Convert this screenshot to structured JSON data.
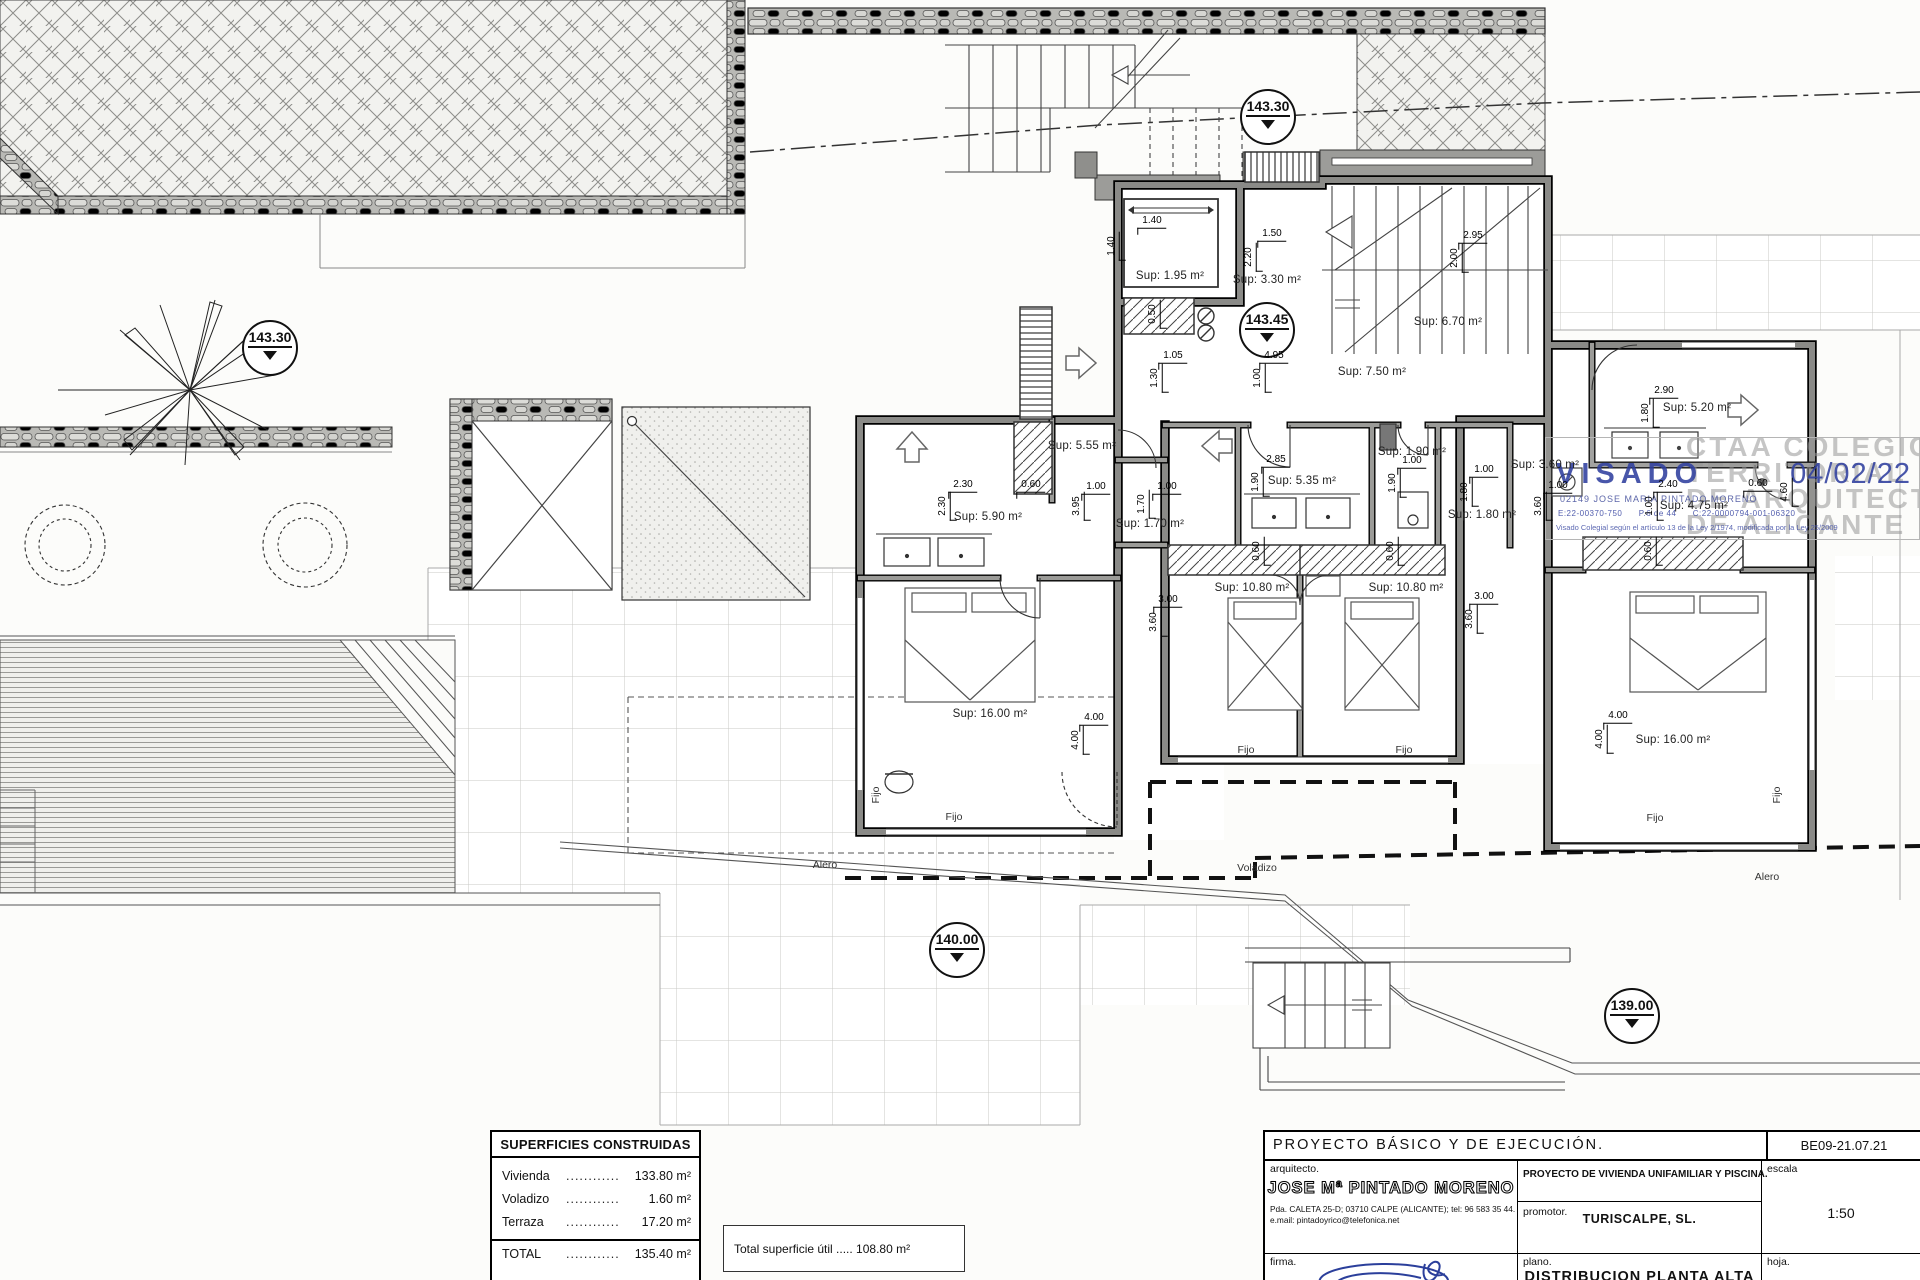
{
  "drawing": {
    "levels": [
      {
        "value": "143.30",
        "x": 1268,
        "y": 117
      },
      {
        "value": "143.45",
        "x": 1267,
        "y": 330
      },
      {
        "value": "143.30",
        "x": 270,
        "y": 348
      },
      {
        "value": "140.00",
        "x": 957,
        "y": 950
      },
      {
        "value": "139.00",
        "x": 1632,
        "y": 1016
      }
    ],
    "rooms": [
      {
        "label": "Sup: 1.95 m²",
        "x": 1170,
        "y": 276
      },
      {
        "label": "Sup: 3.30 m²",
        "x": 1267,
        "y": 280
      },
      {
        "label": "Sup: 6.70 m²",
        "x": 1448,
        "y": 322
      },
      {
        "label": "Sup: 7.50 m²",
        "x": 1372,
        "y": 372
      },
      {
        "label": "Sup: 5.55 m²",
        "x": 1082,
        "y": 446
      },
      {
        "label": "Sup: 5.90 m²",
        "x": 988,
        "y": 517
      },
      {
        "label": "Sup: 1.70 m²",
        "x": 1150,
        "y": 524
      },
      {
        "label": "Sup: 5.35 m²",
        "x": 1302,
        "y": 481
      },
      {
        "label": "Sup: 1.90 m²",
        "x": 1412,
        "y": 452
      },
      {
        "label": "Sup: 1.80 m²",
        "x": 1482,
        "y": 515
      },
      {
        "label": "Sup: 3.60 m²",
        "x": 1545,
        "y": 465
      },
      {
        "label": "Sup: 5.20 m²",
        "x": 1697,
        "y": 408
      },
      {
        "label": "Sup: 4.75 m²",
        "x": 1694,
        "y": 506
      },
      {
        "label": "Sup: 10.80 m²",
        "x": 1252,
        "y": 588
      },
      {
        "label": "Sup: 10.80 m²",
        "x": 1406,
        "y": 588
      },
      {
        "label": "Sup: 16.00 m²",
        "x": 990,
        "y": 714
      },
      {
        "label": "Sup: 16.00 m²",
        "x": 1673,
        "y": 740
      }
    ],
    "dims": [
      {
        "text": "1.40",
        "x": 1152,
        "y": 222
      },
      {
        "text": "1.40",
        "x": 1113,
        "y": 246,
        "v": true
      },
      {
        "text": "1.50",
        "x": 1272,
        "y": 235
      },
      {
        "text": "2.20",
        "x": 1250,
        "y": 257,
        "v": true
      },
      {
        "text": "2.95",
        "x": 1473,
        "y": 237
      },
      {
        "text": "2.00",
        "x": 1456,
        "y": 258,
        "v": true
      },
      {
        "text": "1.05",
        "x": 1173,
        "y": 357
      },
      {
        "text": "1.30",
        "x": 1156,
        "y": 378,
        "v": true
      },
      {
        "text": "4.95",
        "x": 1274,
        "y": 357
      },
      {
        "text": "1.00",
        "x": 1259,
        "y": 378,
        "v": true
      },
      {
        "text": "2.30",
        "x": 963,
        "y": 486
      },
      {
        "text": "2.30",
        "x": 944,
        "y": 506,
        "v": true
      },
      {
        "text": "0.60",
        "x": 1031,
        "y": 486
      },
      {
        "text": "3.95",
        "x": 1078,
        "y": 506,
        "v": true
      },
      {
        "text": "1.00",
        "x": 1096,
        "y": 488
      },
      {
        "text": "1.70",
        "x": 1143,
        "y": 504,
        "v": true
      },
      {
        "text": "1.00",
        "x": 1167,
        "y": 488
      },
      {
        "text": "2.85",
        "x": 1276,
        "y": 461
      },
      {
        "text": "1.90",
        "x": 1257,
        "y": 482,
        "v": true
      },
      {
        "text": "1.00",
        "x": 1412,
        "y": 462
      },
      {
        "text": "1.90",
        "x": 1394,
        "y": 483,
        "v": true
      },
      {
        "text": "1.00",
        "x": 1484,
        "y": 471
      },
      {
        "text": "1.80",
        "x": 1466,
        "y": 492,
        "v": true
      },
      {
        "text": "1.00",
        "x": 1558,
        "y": 487
      },
      {
        "text": "3.60",
        "x": 1540,
        "y": 506,
        "v": true
      },
      {
        "text": "2.90",
        "x": 1664,
        "y": 392
      },
      {
        "text": "1.80",
        "x": 1647,
        "y": 413,
        "v": true
      },
      {
        "text": "2.40",
        "x": 1668,
        "y": 486
      },
      {
        "text": "1.00",
        "x": 1651,
        "y": 506,
        "v": true
      },
      {
        "text": "0.60",
        "x": 1758,
        "y": 485
      },
      {
        "text": "3.00",
        "x": 1168,
        "y": 601
      },
      {
        "text": "3.60",
        "x": 1155,
        "y": 622,
        "v": true
      },
      {
        "text": "3.00",
        "x": 1484,
        "y": 598
      },
      {
        "text": "3.60",
        "x": 1471,
        "y": 619,
        "v": true
      },
      {
        "text": "4.00",
        "x": 1094,
        "y": 719
      },
      {
        "text": "4.00",
        "x": 1077,
        "y": 740,
        "v": true
      },
      {
        "text": "4.00",
        "x": 1618,
        "y": 717
      },
      {
        "text": "4.00",
        "x": 1601,
        "y": 739,
        "v": true
      },
      {
        "text": "4.60",
        "x": 1786,
        "y": 492,
        "v": true
      },
      {
        "text": "0.50",
        "x": 1154,
        "y": 314,
        "v": true
      },
      {
        "text": "0.60",
        "x": 1258,
        "y": 551,
        "v": true
      },
      {
        "text": "0.60",
        "x": 1392,
        "y": 551,
        "v": true
      },
      {
        "text": "0.60",
        "x": 1650,
        "y": 551,
        "v": true
      }
    ],
    "annotations": [
      {
        "text": "Fijo",
        "x": 876,
        "y": 795,
        "v": true
      },
      {
        "text": "Fijo",
        "x": 954,
        "y": 817
      },
      {
        "text": "Fijo",
        "x": 1246,
        "y": 750
      },
      {
        "text": "Fijo",
        "x": 1404,
        "y": 750
      },
      {
        "text": "Fijo",
        "x": 1655,
        "y": 818
      },
      {
        "text": "Fijo",
        "x": 1777,
        "y": 795,
        "v": true
      },
      {
        "text": "Alero",
        "x": 825,
        "y": 865
      },
      {
        "text": "Voladizo",
        "x": 1257,
        "y": 868
      },
      {
        "text": "Alero",
        "x": 1767,
        "y": 877
      }
    ]
  },
  "stamp": {
    "watermark": [
      "CTAA COLEGIO",
      "TERRITORIAL",
      "DE ARQUITECTOS",
      "DE ALICANTE"
    ],
    "visado": "VISADO",
    "date": "04/02/22",
    "colegiado": "02149 JOSE MARIA PINTADO MORENO",
    "refs": "E:22-00370-750      P.6 de 44      C:22-0000794-001-06320",
    "legal": "Visado Colegial según el artículo 13 de la Ley 2/1974, modificada por la Ley 25/2009"
  },
  "areas": {
    "title": "SUPERFICIES CONSTRUIDAS",
    "rows": [
      {
        "name": "Vivienda",
        "dots": "............",
        "value": "133.80 m²"
      },
      {
        "name": "Voladizo",
        "dots": "............",
        "value": "1.60 m²"
      },
      {
        "name": "Terraza",
        "dots": "............",
        "value": "17.20 m²"
      }
    ],
    "total": {
      "name": "TOTAL",
      "dots": "............",
      "value": "135.40 m²"
    }
  },
  "total_note": "Total superficie útil ..... 108.80 m²",
  "titleblock": {
    "header": "PROYECTO  BÁSICO  Y  DE  EJECUCIÓN.",
    "code": "BE09-21.07.21",
    "arquitecto_label": "arquitecto.",
    "arquitecto_name": "JOSE Mª PINTADO MORENO",
    "address": "Pda. CALETA 25-D; 03710 CALPE (ALICANTE); tel: 96 583 35 44.",
    "email": "e.mail: pintadoyrico@telefonica.net",
    "project": "PROYECTO DE VIVIENDA UNIFAMILIAR Y PISCINA.",
    "promotor_label": "promotor.",
    "promotor_name": "TURISCALPE, SL.",
    "escala_label": "escala",
    "escala_value": "1:50",
    "firma_label": "firma.",
    "plano_label": "plano.",
    "plano_name": "DISTRIBUCION  PLANTA  ALTA",
    "hoja_label": "hoja."
  }
}
